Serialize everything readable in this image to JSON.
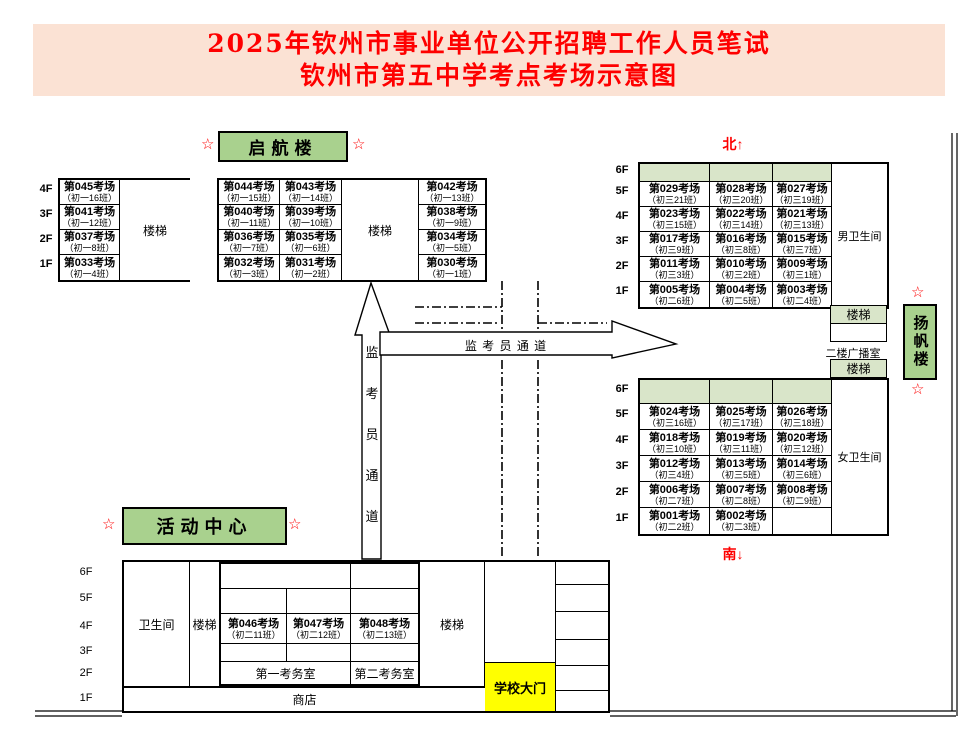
{
  "title": {
    "line1": "2025年钦州市事业单位公开招聘工作人员笔试",
    "line2": "钦州市第五中学考点考场示意图"
  },
  "compass": {
    "north": "北↑",
    "south": "南↓"
  },
  "passage": {
    "vertical": "监考员通道",
    "horizontal": "监 考 员 通 道"
  },
  "labels": {
    "stairs": "楼梯",
    "star": "☆",
    "broadcast_room": "二楼广播室"
  },
  "buildings": {
    "qihang": {
      "label": "启航楼",
      "floors": [
        "4F",
        "3F",
        "2F",
        "1F"
      ],
      "left_rooms": [
        [
          "第045考场",
          "（初一16班）"
        ],
        [
          "第041考场",
          "（初一12班）"
        ],
        [
          "第037考场",
          "（初一8班）"
        ],
        [
          "第033考场",
          "（初一4班）"
        ]
      ],
      "mid_col1": [
        [
          "第044考场",
          "（初一15班）"
        ],
        [
          "第040考场",
          "（初一11班）"
        ],
        [
          "第036考场",
          "（初一7班）"
        ],
        [
          "第032考场",
          "（初一3班）"
        ]
      ],
      "mid_col2": [
        [
          "第043考场",
          "（初一14班）"
        ],
        [
          "第039考场",
          "（初一10班）"
        ],
        [
          "第035考场",
          "（初一6班）"
        ],
        [
          "第031考场",
          "（初一2班）"
        ]
      ],
      "right_rooms": [
        [
          "第042考场",
          "（初一13班）"
        ],
        [
          "第038考场",
          "（初一9班）"
        ],
        [
          "第034考场",
          "（初一5班）"
        ],
        [
          "第030考场",
          "（初一1班）"
        ]
      ]
    },
    "yangfan": {
      "label": "扬帆楼",
      "north_floors": [
        "6F",
        "5F",
        "4F",
        "3F",
        "2F",
        "1F"
      ],
      "south_floors": [
        "6F",
        "5F",
        "4F",
        "3F",
        "2F",
        "1F"
      ],
      "male_restroom": "男卫生间",
      "female_restroom": "女卫生间",
      "north_rows": [
        [
          null,
          null,
          null
        ],
        [
          [
            "第029考场",
            "（初三21班）"
          ],
          [
            "第028考场",
            "（初三20班）"
          ],
          [
            "第027考场",
            "（初三19班）"
          ]
        ],
        [
          [
            "第023考场",
            "（初三15班）"
          ],
          [
            "第022考场",
            "（初三14班）"
          ],
          [
            "第021考场",
            "（初三13班）"
          ]
        ],
        [
          [
            "第017考场",
            "（初三9班）"
          ],
          [
            "第016考场",
            "（初三8班）"
          ],
          [
            "第015考场",
            "（初三7班）"
          ]
        ],
        [
          [
            "第011考场",
            "（初三3班）"
          ],
          [
            "第010考场",
            "（初三2班）"
          ],
          [
            "第009考场",
            "（初三1班）"
          ]
        ],
        [
          [
            "第005考场",
            "（初二6班）"
          ],
          [
            "第004考场",
            "（初二5班）"
          ],
          [
            "第003考场",
            "（初二4班）"
          ]
        ]
      ],
      "south_rows": [
        [
          null,
          null,
          null
        ],
        [
          [
            "第024考场",
            "（初三16班）"
          ],
          [
            "第025考场",
            "（初三17班）"
          ],
          [
            "第026考场",
            "（初三18班）"
          ]
        ],
        [
          [
            "第018考场",
            "（初三10班）"
          ],
          [
            "第019考场",
            "（初三11班）"
          ],
          [
            "第020考场",
            "（初三12班）"
          ]
        ],
        [
          [
            "第012考场",
            "（初三4班）"
          ],
          [
            "第013考场",
            "（初三5班）"
          ],
          [
            "第014考场",
            "（初三6班）"
          ]
        ],
        [
          [
            "第006考场",
            "（初二7班）"
          ],
          [
            "第007考场",
            "（初二8班）"
          ],
          [
            "第008考场",
            "（初二9班）"
          ]
        ],
        [
          [
            "第001考场",
            "（初二2班）"
          ],
          [
            "第002考场",
            "（初二3班）"
          ],
          null
        ]
      ]
    },
    "activity": {
      "label": "活动中心",
      "floors": [
        "6F",
        "5F",
        "4F",
        "3F",
        "2F",
        "1F"
      ],
      "restroom": "卫生间",
      "shop": "商店",
      "school_gate": "学校大门",
      "exam_office_1": "第一考务室",
      "exam_office_2": "第二考务室",
      "rooms": [
        [
          "第046考场",
          "（初二11班）"
        ],
        [
          "第047考场",
          "（初二12班）"
        ],
        [
          "第048考场",
          "（初二13班）"
        ]
      ]
    }
  },
  "colors": {
    "accent_green": "#a9d18e",
    "light_green": "#d9e5c9",
    "title_bg": "#fbe2d4",
    "title_red": "#fe0000",
    "gate_yellow": "#ffff00"
  }
}
